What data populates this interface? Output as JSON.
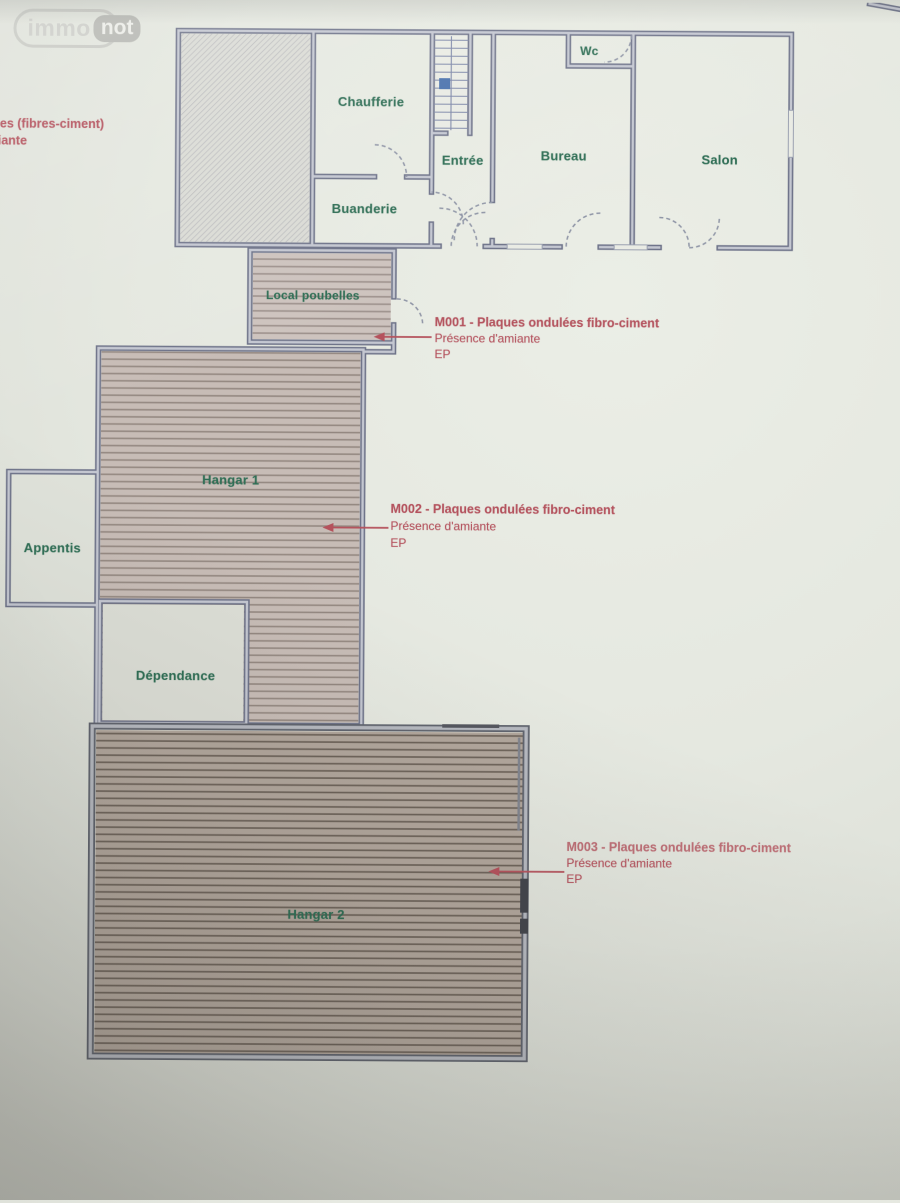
{
  "watermark": {
    "immo": "immo",
    "not": "not"
  },
  "left_note": {
    "line1": "es (fibres-ciment)",
    "line2": "iante"
  },
  "floorplan": {
    "rooms": {
      "chaufferie": {
        "label": "Chaufferie"
      },
      "buanderie": {
        "label": "Buanderie"
      },
      "entree": {
        "label": "Entrée"
      },
      "wc": {
        "label": "Wc"
      },
      "bureau": {
        "label": "Bureau"
      },
      "salon": {
        "label": "Salon"
      },
      "local_poubelles": {
        "label": "Local poubelles"
      },
      "hangar1": {
        "label": "Hangar 1"
      },
      "appentis": {
        "label": "Appentis"
      },
      "dependance": {
        "label": "Dépendance"
      },
      "hangar2": {
        "label": "Hangar 2"
      }
    },
    "annotations": {
      "m001": {
        "title": "M001 - Plaques ondulées fibro-ciment",
        "line2": "Présence d'amiante",
        "line3": "EP"
      },
      "m002": {
        "title": "M002 - Plaques ondulées fibro-ciment",
        "line2": "Présence d'amiante",
        "line3": "EP"
      },
      "m003": {
        "title": "M003 - Plaques ondulées fibro-ciment",
        "line2": "Présence d'amiante",
        "line3": "EP"
      }
    },
    "colors": {
      "room_label": "#2f6e55",
      "annotation": "#b4535e",
      "wall": "#6e7389",
      "stair_marker": "#4a72ad"
    }
  }
}
